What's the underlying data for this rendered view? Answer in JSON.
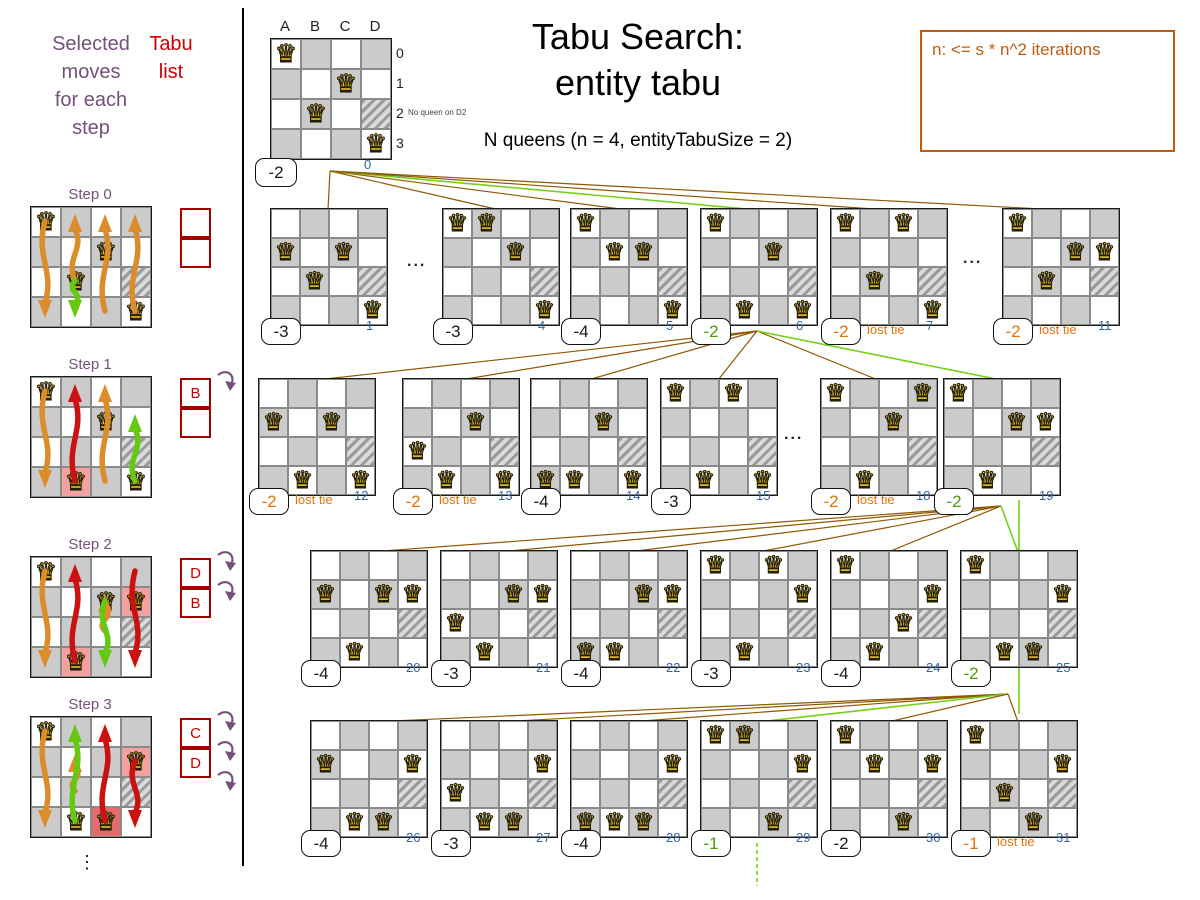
{
  "colors": {
    "purple": "#75507b",
    "red_text": "#cc0000",
    "tabu_border": "#a40000",
    "score_orange": "#e1730a",
    "note_orange": "#c35b0d",
    "index_blue": "#3465a4",
    "score_green": "#4e9a06",
    "edge_green": "#73d216",
    "edge_brown": "#8f5902",
    "cell_gray": "#cbcbcb",
    "highlight_pink": "#f2a0a0",
    "highlight_red": "#e26b6b",
    "arrow_orange": "#dc8c28",
    "arrow_red": "#cc1111",
    "arrow_green": "#65c90f"
  },
  "title": {
    "line1": "Tabu Search:",
    "line2": "entity tabu",
    "subtitle": "N queens (n = 4, entityTabuSize = 2)"
  },
  "note": {
    "text": "n: <= s * n^2 iterations"
  },
  "left_panel": {
    "heading": [
      "Selected",
      "moves",
      "for each",
      "step"
    ],
    "tabu_label": [
      "Tabu",
      "list"
    ],
    "continuation": "⋮",
    "steps": [
      {
        "label": "Step 0",
        "y": 186,
        "queens": [
          "A0",
          "C1",
          "B2",
          "D3"
        ],
        "highlights": {},
        "arrows": [
          [
            "A",
            0,
            3,
            "orange"
          ],
          [
            "B",
            2,
            0,
            "orange"
          ],
          [
            "C",
            3,
            0,
            "orange"
          ],
          [
            "D",
            3,
            0,
            "orange"
          ],
          [
            "B",
            2,
            3,
            "green"
          ]
        ],
        "tabu": [
          "",
          ""
        ],
        "undo_arrows": 0
      },
      {
        "label": "Step 1",
        "y": 356,
        "queens": [
          "A0",
          "C1",
          "B3",
          "D3"
        ],
        "highlights": {
          "B3": "pink"
        },
        "arrows": [
          [
            "A",
            0,
            3,
            "orange"
          ],
          [
            "C",
            3,
            0,
            "orange"
          ],
          [
            "B",
            3,
            0,
            "red"
          ],
          [
            "D",
            3,
            1,
            "green"
          ]
        ],
        "tabu": [
          "B",
          ""
        ],
        "undo_arrows": 1
      },
      {
        "label": "Step 2",
        "y": 536,
        "queens": [
          "A0",
          "C1",
          "D1",
          "B3"
        ],
        "highlights": {
          "D1": "pink",
          "B3": "pink"
        },
        "arrows": [
          [
            "A",
            0,
            3,
            "orange"
          ],
          [
            "C",
            2,
            1,
            "orange"
          ],
          [
            "B",
            3,
            0,
            "red"
          ],
          [
            "D",
            0,
            3,
            "red"
          ],
          [
            "C",
            1,
            3,
            "green"
          ]
        ],
        "tabu": [
          "D",
          "B"
        ],
        "undo_arrows": 2
      },
      {
        "label": "Step 3",
        "y": 696,
        "queens": [
          "A0",
          "D1",
          "B3",
          "C3"
        ],
        "highlights": {
          "D1": "pink",
          "C3": "red"
        },
        "arrows": [
          [
            "A",
            0,
            3,
            "orange"
          ],
          [
            "B",
            2,
            1,
            "orange"
          ],
          [
            "C",
            3,
            0,
            "red"
          ],
          [
            "D",
            1,
            3,
            "red"
          ],
          [
            "B",
            3,
            0,
            "green"
          ]
        ],
        "tabu": [
          "C",
          "D"
        ],
        "undo_arrows": 3
      }
    ]
  },
  "root": {
    "x": 270,
    "y": 38,
    "columns": [
      "A",
      "B",
      "C",
      "D"
    ],
    "row_labels": [
      "0",
      "1",
      "2",
      "3"
    ],
    "queens": [
      "A0",
      "C1",
      "B2",
      "D3"
    ],
    "score": "-2",
    "index": "0",
    "annotation": "No queen on D2"
  },
  "lost_tie_label": "lost tie",
  "tree": {
    "rows": [
      {
        "y": 208,
        "origin": [
          330,
          171
        ],
        "gaps": [
          [
            407,
            253
          ],
          [
            963,
            250
          ]
        ],
        "boards": [
          {
            "index": "1",
            "x": 270,
            "score": "-3",
            "status": "normal",
            "queens": [
              "A1",
              "C1",
              "B2",
              "D3"
            ]
          },
          {
            "index": "4",
            "x": 442,
            "score": "-3",
            "status": "normal",
            "queens": [
              "A0",
              "B0",
              "C1",
              "D3"
            ]
          },
          {
            "index": "5",
            "x": 570,
            "score": "-4",
            "status": "normal",
            "queens": [
              "A0",
              "B1",
              "C1",
              "D3"
            ]
          },
          {
            "index": "6",
            "x": 700,
            "score": "-2",
            "status": "win",
            "queens": [
              "A0",
              "C1",
              "B3",
              "D3"
            ]
          },
          {
            "index": "7",
            "x": 830,
            "score": "-2",
            "status": "lost",
            "queens": [
              "A0",
              "C0",
              "B2",
              "D3"
            ]
          },
          {
            "index": "11",
            "x": 1002,
            "score": "-2",
            "status": "lost",
            "queens": [
              "A0",
              "C1",
              "D1",
              "B2"
            ]
          }
        ]
      },
      {
        "y": 378,
        "origin": [
          757,
          331
        ],
        "gaps": [
          [
            784,
            426
          ]
        ],
        "boards": [
          {
            "index": "12",
            "x": 258,
            "score": "-2",
            "status": "lost",
            "queens": [
              "A1",
              "C1",
              "B3",
              "D3"
            ]
          },
          {
            "index": "13",
            "x": 402,
            "score": "-2",
            "status": "lost",
            "queens": [
              "A2",
              "C1",
              "B3",
              "D3"
            ]
          },
          {
            "index": "14",
            "x": 530,
            "score": "-4",
            "status": "normal",
            "queens": [
              "A3",
              "C1",
              "B3",
              "D3"
            ]
          },
          {
            "index": "15",
            "x": 660,
            "score": "-3",
            "status": "normal",
            "queens": [
              "A0",
              "C0",
              "B3",
              "D3"
            ]
          },
          {
            "index": "18",
            "x": 820,
            "score": "-2",
            "status": "lost",
            "queens": [
              "A0",
              "D0",
              "C1",
              "B3"
            ]
          },
          {
            "index": "19",
            "x": 943,
            "score": "-2",
            "status": "win",
            "queens": [
              "A0",
              "C1",
              "D1",
              "B3"
            ]
          }
        ]
      },
      {
        "y": 550,
        "origin": [
          1001,
          506
        ],
        "gaps": [],
        "boards": [
          {
            "index": "20",
            "x": 310,
            "score": "-4",
            "status": "normal",
            "queens": [
              "A1",
              "C1",
              "D1",
              "B3"
            ]
          },
          {
            "index": "21",
            "x": 440,
            "score": "-3",
            "status": "normal",
            "queens": [
              "A2",
              "C1",
              "D1",
              "B3"
            ]
          },
          {
            "index": "22",
            "x": 570,
            "score": "-4",
            "status": "normal",
            "queens": [
              "A3",
              "C1",
              "D1",
              "B3"
            ]
          },
          {
            "index": "23",
            "x": 700,
            "score": "-3",
            "status": "normal",
            "queens": [
              "A0",
              "C0",
              "D1",
              "B3"
            ]
          },
          {
            "index": "24",
            "x": 830,
            "score": "-4",
            "status": "normal",
            "queens": [
              "A0",
              "C2",
              "D1",
              "B3"
            ]
          },
          {
            "index": "25",
            "x": 960,
            "score": "-2",
            "status": "win",
            "queens": [
              "A0",
              "D1",
              "B3",
              "C3"
            ]
          }
        ]
      },
      {
        "y": 720,
        "origin": [
          1008,
          694
        ],
        "gaps": [],
        "boards": [
          {
            "index": "26",
            "x": 310,
            "score": "-4",
            "status": "normal",
            "queens": [
              "A1",
              "D1",
              "B3",
              "C3"
            ]
          },
          {
            "index": "27",
            "x": 440,
            "score": "-3",
            "status": "normal",
            "queens": [
              "A2",
              "D1",
              "B3",
              "C3"
            ]
          },
          {
            "index": "28",
            "x": 570,
            "score": "-4",
            "status": "normal",
            "queens": [
              "A3",
              "D1",
              "B3",
              "C3"
            ]
          },
          {
            "index": "29",
            "x": 700,
            "score": "-1",
            "status": "win",
            "queens": [
              "A0",
              "B0",
              "D1",
              "C3"
            ]
          },
          {
            "index": "30",
            "x": 830,
            "score": "-2",
            "status": "normal",
            "queens": [
              "A0",
              "B1",
              "D1",
              "C3"
            ]
          },
          {
            "index": "31",
            "x": 960,
            "score": "-1",
            "status": "lost",
            "queens": [
              "A0",
              "B2",
              "D1",
              "C3"
            ]
          }
        ]
      }
    ],
    "extra_segments": [
      {
        "x1": 1019,
        "y1": 500,
        "x2": 1019,
        "y2": 714,
        "color": "green",
        "dashed": false
      },
      {
        "x1": 757,
        "y1": 843,
        "x2": 757,
        "y2": 886,
        "color": "green",
        "dashed": true
      }
    ]
  }
}
